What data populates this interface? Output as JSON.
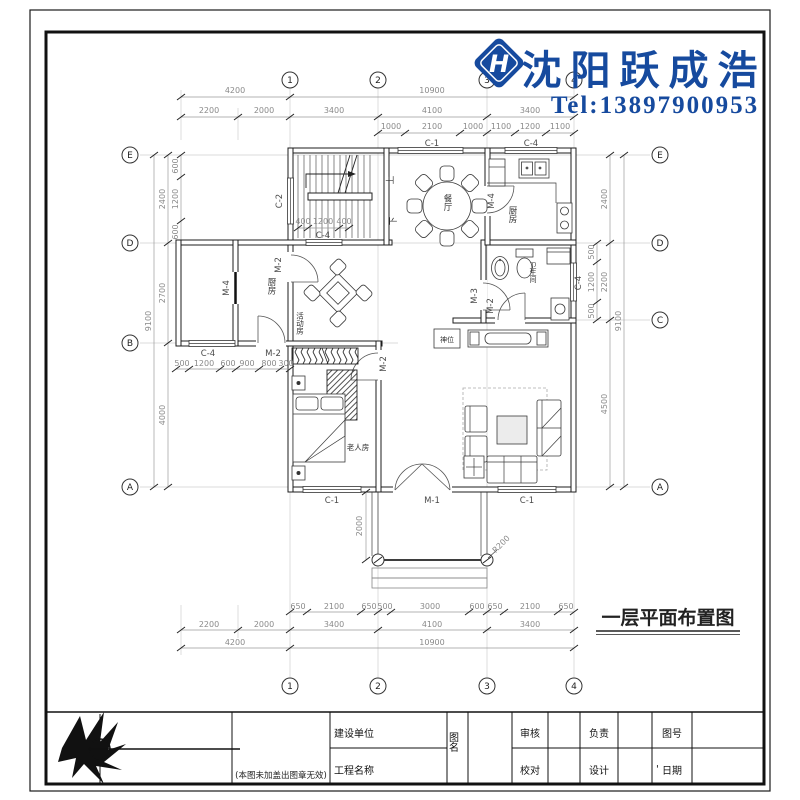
{
  "header": {
    "brand": "沈阳跃成浩",
    "tel": "Tel:13897900953",
    "logo_letter": "H"
  },
  "drawing_title": "一层平面布置图",
  "grid": {
    "top": [
      "1",
      "2",
      "3",
      "4"
    ],
    "bottom": [
      "1",
      "2",
      "3",
      "4"
    ],
    "left": [
      "E",
      "D",
      "B",
      "A"
    ],
    "right": [
      "E",
      "D",
      "C",
      "A"
    ]
  },
  "dims": {
    "top_row1": [
      "4200",
      "10900"
    ],
    "top_row2": [
      "2200",
      "2000",
      "3400",
      "4100",
      "3400"
    ],
    "top_row3": [
      "1000",
      "2100",
      "1000",
      "1100",
      "1200",
      "1100"
    ],
    "bottom_row1": [
      "650",
      "2100",
      "650",
      "500",
      "3000",
      "600",
      "650",
      "2100",
      "650"
    ],
    "bottom_row2": [
      "2200",
      "2000",
      "3400",
      "4100",
      "3400"
    ],
    "bottom_row3": [
      "4200",
      "10900"
    ],
    "left_overall": "9100",
    "left_segments": [
      "2400",
      "2700",
      "4000"
    ],
    "left_sub": [
      "600",
      "1200",
      "600"
    ],
    "right_overall": "9100",
    "right_segments": [
      "2400",
      "2200",
      "4500"
    ],
    "right_sub": [
      "500",
      "1200",
      "500"
    ],
    "int_top": [
      "400",
      "1200",
      "400"
    ],
    "int_b": [
      "500",
      "1200",
      "600",
      "900",
      "800",
      "300"
    ],
    "porch_depth": "2000",
    "column_radius": "R200"
  },
  "openings": {
    "c1": "C-1",
    "c2": "C-2",
    "c4": "C-4",
    "m1": "M-1",
    "m2": "M-2",
    "m3": "M-3",
    "m4": "M-4"
  },
  "rooms": {
    "dining": "餐厅",
    "kitchen": "厨房",
    "bathroom": "卫生间",
    "activity": "活动房",
    "elder_room": "老人房",
    "shrine": "神位",
    "stair_up": "上",
    "stair_down": "下"
  },
  "title_block": {
    "note": "(本图未加盖出图章无效)",
    "owner_label": "建设单位",
    "project_label": "工程名称",
    "sheet_name_label": "图名",
    "review_label": "审核",
    "check_label": "校对",
    "lead_label": "负责",
    "design_label": "设计",
    "sheet_no_label": "图号",
    "date_label": "日期",
    "tick": "'"
  }
}
